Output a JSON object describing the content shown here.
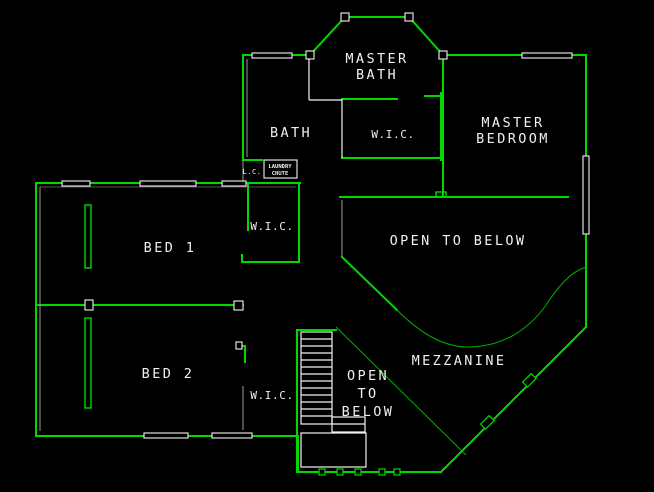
{
  "colors": {
    "background": "#000000",
    "wall": "#00d900",
    "wall_thin": "#00b000",
    "interior": "#f2f2f2",
    "interior_gray": "#9c9c9c",
    "text": "#f0f0f0"
  },
  "rooms": {
    "master_bath": {
      "line1": "MASTER",
      "line2": "BATH"
    },
    "bath": {
      "label": "BATH"
    },
    "master_wic": {
      "label": "W.I.C."
    },
    "master_bedroom": {
      "line1": "MASTER",
      "line2": "BEDROOM"
    },
    "open_to_below_upper": {
      "label": "OPEN TO BELOW"
    },
    "bed_1": {
      "label": "BED 1"
    },
    "bed_1_wic": {
      "label": "W.I.C."
    },
    "bed_2": {
      "label": "BED 2"
    },
    "bed_2_wic": {
      "label": "W.I.C."
    },
    "open_to_below_lower": {
      "line1": "OPEN",
      "line2": "TO",
      "line3": "BELOW"
    },
    "mezzanine": {
      "label": "MEZZANINE"
    },
    "linen_closet": {
      "label": "L.C."
    },
    "laundry_chute": {
      "line1": "LAUNDRY",
      "line2": "CHUTE"
    }
  }
}
